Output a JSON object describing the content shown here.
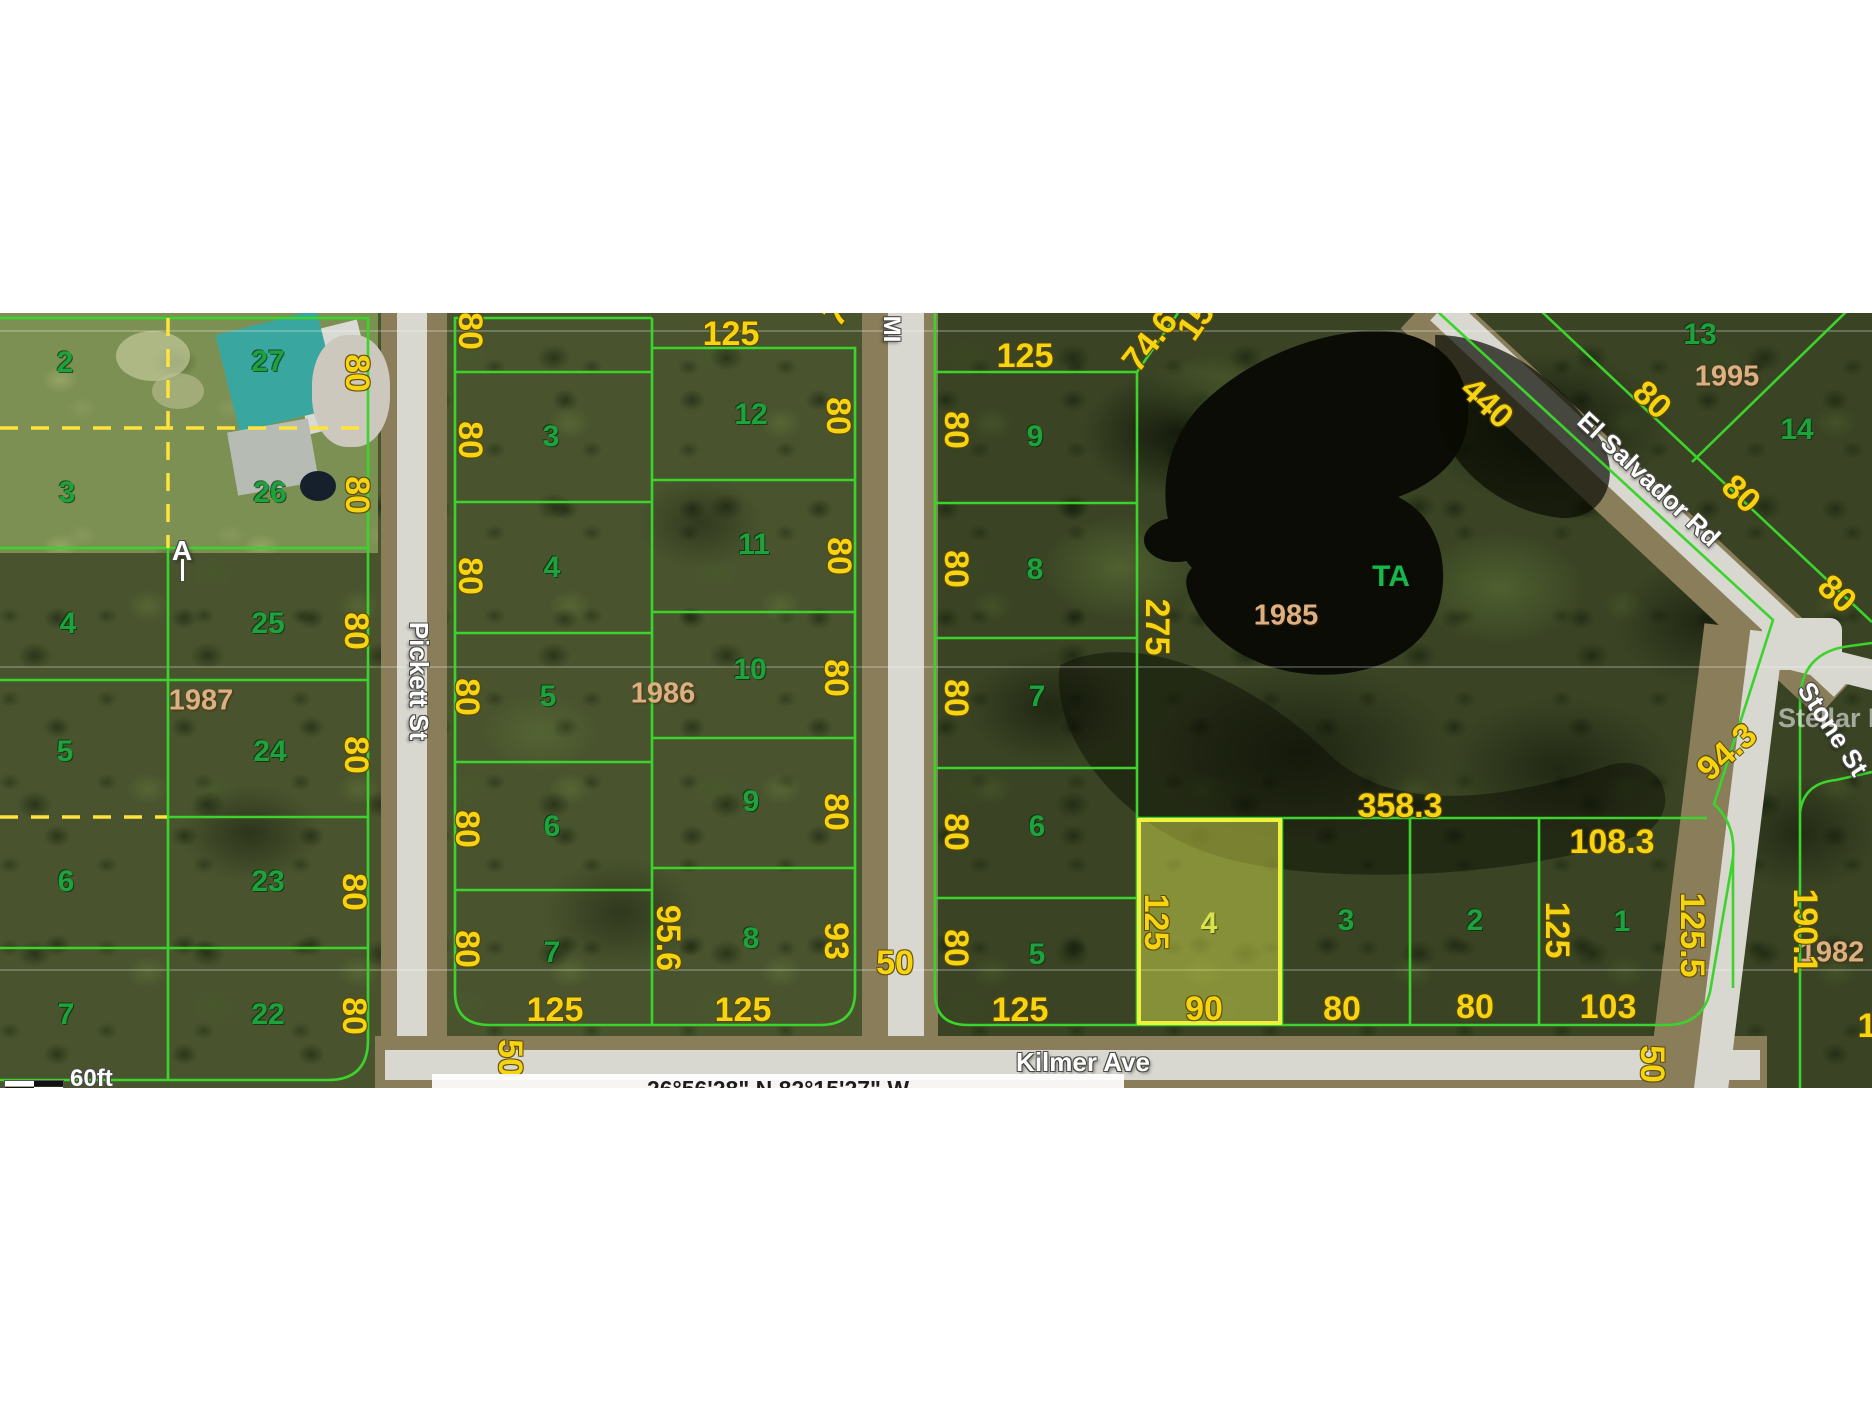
{
  "map": {
    "title": "Aerial plat map with lot dimensions",
    "scale_label": "60ft",
    "coordinates": "26°56'28\" N 82°15'27\" W",
    "watermark": "Stellar MLS",
    "streets": [
      "Pickett St",
      "MI",
      "Kilmer Ave",
      "El Salvador Rd",
      "Stone St"
    ],
    "blocks": [
      "1987",
      "1986",
      "1985",
      "1995",
      "1982"
    ],
    "subject_parcel": {
      "number": "4",
      "block": "1985",
      "frontage": "90",
      "depth": "125"
    },
    "colors": {
      "boundary_green": "#3bd32c",
      "dashed_yellow": "#ffe23c",
      "dimension_yellow": "#f6d411",
      "parcel_green": "#1fa23d",
      "block_tan": "#ddb083",
      "subject_highlight": "#eef23c",
      "water_dark": "#0a0c05"
    },
    "labels": [
      {
        "name": "parcel-2",
        "text": "2",
        "x": 65,
        "y": 363,
        "cls": "num"
      },
      {
        "name": "parcel-27",
        "text": "27",
        "x": 268,
        "y": 362,
        "cls": "num"
      },
      {
        "name": "parcel-3a",
        "text": "3",
        "x": 67,
        "y": 493,
        "cls": "num"
      },
      {
        "name": "parcel-26",
        "text": "26",
        "x": 270,
        "y": 493,
        "cls": "num"
      },
      {
        "name": "parcel-4a",
        "text": "4",
        "x": 68,
        "y": 624,
        "cls": "num"
      },
      {
        "name": "parcel-25",
        "text": "25",
        "x": 268,
        "y": 624,
        "cls": "num"
      },
      {
        "name": "parcel-5a",
        "text": "5",
        "x": 65,
        "y": 752,
        "cls": "num"
      },
      {
        "name": "parcel-24",
        "text": "24",
        "x": 270,
        "y": 752,
        "cls": "num"
      },
      {
        "name": "parcel-6a",
        "text": "6",
        "x": 66,
        "y": 882,
        "cls": "num"
      },
      {
        "name": "parcel-23",
        "text": "23",
        "x": 268,
        "y": 882,
        "cls": "num"
      },
      {
        "name": "parcel-7a",
        "text": "7",
        "x": 66,
        "y": 1015,
        "cls": "num"
      },
      {
        "name": "parcel-22",
        "text": "22",
        "x": 268,
        "y": 1015,
        "cls": "num"
      },
      {
        "name": "dim-80",
        "text": "80",
        "x": 357,
        "y": 373,
        "rot": 90,
        "cls": "dim"
      },
      {
        "name": "dim-80",
        "text": "80",
        "x": 357,
        "y": 495,
        "rot": 90,
        "cls": "dim"
      },
      {
        "name": "dim-80",
        "text": "80",
        "x": 356,
        "y": 631,
        "rot": 90,
        "cls": "dim"
      },
      {
        "name": "dim-80",
        "text": "80",
        "x": 356,
        "y": 755,
        "rot": 90,
        "cls": "dim"
      },
      {
        "name": "dim-80",
        "text": "80",
        "x": 354,
        "y": 892,
        "rot": 90,
        "cls": "dim"
      },
      {
        "name": "dim-80",
        "text": "80",
        "x": 354,
        "y": 1016,
        "rot": 90,
        "cls": "dim"
      },
      {
        "name": "block-1987",
        "text": "1987",
        "x": 201,
        "y": 701,
        "cls": "blk"
      },
      {
        "name": "marker-a",
        "text": "A",
        "x": 182,
        "y": 551,
        "cls": "st",
        "fs": 28
      },
      {
        "name": "parcel-3b",
        "text": "3",
        "x": 551,
        "y": 437,
        "cls": "num"
      },
      {
        "name": "parcel-4b",
        "text": "4",
        "x": 552,
        "y": 568,
        "cls": "num"
      },
      {
        "name": "parcel-5b",
        "text": "5",
        "x": 548,
        "y": 697,
        "cls": "num"
      },
      {
        "name": "parcel-6b",
        "text": "6",
        "x": 552,
        "y": 827,
        "cls": "num"
      },
      {
        "name": "parcel-7b",
        "text": "7",
        "x": 552,
        "y": 953,
        "cls": "num"
      },
      {
        "name": "parcel-12",
        "text": "12",
        "x": 751,
        "y": 415,
        "cls": "num"
      },
      {
        "name": "parcel-11",
        "text": "11",
        "x": 754,
        "y": 545,
        "cls": "num"
      },
      {
        "name": "parcel-10",
        "text": "10",
        "x": 750,
        "y": 670,
        "cls": "num"
      },
      {
        "name": "parcel-9b",
        "text": "9",
        "x": 751,
        "y": 802,
        "cls": "num"
      },
      {
        "name": "parcel-8b",
        "text": "8",
        "x": 751,
        "y": 939,
        "cls": "num"
      },
      {
        "name": "block-1986",
        "text": "1986",
        "x": 663,
        "y": 694,
        "cls": "blk"
      },
      {
        "name": "dim-80",
        "text": "80",
        "x": 470,
        "y": 331,
        "rot": 90,
        "cls": "dim"
      },
      {
        "name": "dim-80",
        "text": "80",
        "x": 470,
        "y": 440,
        "rot": 90,
        "cls": "dim"
      },
      {
        "name": "dim-80",
        "text": "80",
        "x": 470,
        "y": 576,
        "rot": 90,
        "cls": "dim"
      },
      {
        "name": "dim-80",
        "text": "80",
        "x": 467,
        "y": 697,
        "rot": 90,
        "cls": "dim"
      },
      {
        "name": "dim-80",
        "text": "80",
        "x": 467,
        "y": 829,
        "rot": 90,
        "cls": "dim"
      },
      {
        "name": "dim-80",
        "text": "80",
        "x": 467,
        "y": 949,
        "rot": 90,
        "cls": "dim"
      },
      {
        "name": "dim-80",
        "text": "80",
        "x": 838,
        "y": 416,
        "rot": 90,
        "cls": "dim"
      },
      {
        "name": "dim-80",
        "text": "80",
        "x": 839,
        "y": 556,
        "rot": 90,
        "cls": "dim"
      },
      {
        "name": "dim-80",
        "text": "80",
        "x": 836,
        "y": 678,
        "rot": 90,
        "cls": "dim"
      },
      {
        "name": "dim-80",
        "text": "80",
        "x": 836,
        "y": 812,
        "rot": 90,
        "cls": "dim"
      },
      {
        "name": "dim-93",
        "text": "93",
        "x": 836,
        "y": 941,
        "rot": 90,
        "cls": "dim"
      },
      {
        "name": "dim-95-6",
        "text": "95.6",
        "x": 668,
        "y": 938,
        "rot": 90,
        "cls": "dim"
      },
      {
        "name": "dim-125",
        "text": "125",
        "x": 731,
        "y": 334,
        "cls": "dim"
      },
      {
        "name": "dim-125",
        "text": "125",
        "x": 555,
        "y": 1010,
        "cls": "dim"
      },
      {
        "name": "dim-125",
        "text": "125",
        "x": 743,
        "y": 1010,
        "cls": "dim"
      },
      {
        "name": "dim-partial",
        "text": "7",
        "x": 836,
        "y": 314,
        "rot": -50,
        "cls": "dim"
      },
      {
        "name": "dim-50",
        "text": "50",
        "x": 895,
        "y": 963,
        "cls": "dim"
      },
      {
        "name": "dim-50",
        "text": "50",
        "x": 510,
        "y": 1058,
        "rot": 90,
        "cls": "dim"
      },
      {
        "name": "dim-50",
        "text": "50",
        "x": 1652,
        "y": 1064,
        "rot": 90,
        "cls": "dim"
      },
      {
        "name": "parcel-9c",
        "text": "9",
        "x": 1035,
        "y": 437,
        "cls": "num"
      },
      {
        "name": "parcel-8c",
        "text": "8",
        "x": 1035,
        "y": 570,
        "cls": "num"
      },
      {
        "name": "parcel-7c",
        "text": "7",
        "x": 1037,
        "y": 697,
        "cls": "num"
      },
      {
        "name": "parcel-6c",
        "text": "6",
        "x": 1037,
        "y": 827,
        "cls": "num"
      },
      {
        "name": "parcel-5c",
        "text": "5",
        "x": 1037,
        "y": 955,
        "cls": "num"
      },
      {
        "name": "dim-80",
        "text": "80",
        "x": 956,
        "y": 430,
        "rot": 90,
        "cls": "dim"
      },
      {
        "name": "dim-80",
        "text": "80",
        "x": 956,
        "y": 569,
        "rot": 90,
        "cls": "dim"
      },
      {
        "name": "dim-80",
        "text": "80",
        "x": 956,
        "y": 698,
        "rot": 90,
        "cls": "dim"
      },
      {
        "name": "dim-80",
        "text": "80",
        "x": 956,
        "y": 832,
        "rot": 90,
        "cls": "dim"
      },
      {
        "name": "dim-80",
        "text": "80",
        "x": 956,
        "y": 948,
        "rot": 90,
        "cls": "dim"
      },
      {
        "name": "dim-125",
        "text": "125",
        "x": 1025,
        "y": 356,
        "cls": "dim"
      },
      {
        "name": "dim-74-6",
        "text": "74.6",
        "x": 1150,
        "y": 341,
        "rot": -52,
        "cls": "dim"
      },
      {
        "name": "dim-partial-15",
        "text": "15",
        "x": 1196,
        "y": 321,
        "rot": -55,
        "cls": "dim"
      },
      {
        "name": "dim-275",
        "text": "275",
        "x": 1157,
        "y": 627,
        "rot": 90,
        "cls": "dim"
      },
      {
        "name": "label-ta",
        "text": "TA",
        "x": 1391,
        "y": 577,
        "cls": "ta"
      },
      {
        "name": "block-1985",
        "text": "1985",
        "x": 1286,
        "y": 616,
        "cls": "blk"
      },
      {
        "name": "dim-358-3",
        "text": "358.3",
        "x": 1400,
        "y": 806,
        "cls": "dim"
      },
      {
        "name": "dim-108-3",
        "text": "108.3",
        "x": 1612,
        "y": 842,
        "cls": "dim"
      },
      {
        "name": "parcel-4-subject",
        "text": "4",
        "x": 1209,
        "y": 924,
        "cls": "numy"
      },
      {
        "name": "parcel-3c",
        "text": "3",
        "x": 1346,
        "y": 921,
        "cls": "num"
      },
      {
        "name": "parcel-2c",
        "text": "2",
        "x": 1475,
        "y": 921,
        "cls": "num"
      },
      {
        "name": "parcel-1",
        "text": "1",
        "x": 1622,
        "y": 922,
        "cls": "num"
      },
      {
        "name": "dim-125",
        "text": "125",
        "x": 1156,
        "y": 922,
        "rot": 90,
        "cls": "dim"
      },
      {
        "name": "dim-90",
        "text": "90",
        "x": 1204,
        "y": 1009,
        "cls": "dim"
      },
      {
        "name": "dim-80",
        "text": "80",
        "x": 1342,
        "y": 1009,
        "cls": "dim"
      },
      {
        "name": "dim-80",
        "text": "80",
        "x": 1475,
        "y": 1007,
        "cls": "dim"
      },
      {
        "name": "dim-103",
        "text": "103",
        "x": 1608,
        "y": 1007,
        "cls": "dim"
      },
      {
        "name": "dim-125",
        "text": "125",
        "x": 1020,
        "y": 1010,
        "cls": "dim"
      },
      {
        "name": "dim-125",
        "text": "125",
        "x": 1557,
        "y": 930,
        "rot": 90,
        "cls": "dim"
      },
      {
        "name": "dim-125-5",
        "text": "125.5",
        "x": 1692,
        "y": 935,
        "rot": 90,
        "cls": "dim"
      },
      {
        "name": "dim-94-3",
        "text": "94.3",
        "x": 1727,
        "y": 752,
        "rot": -42,
        "cls": "dim"
      },
      {
        "name": "parcel-13",
        "text": "13",
        "x": 1700,
        "y": 335,
        "cls": "num"
      },
      {
        "name": "parcel-14",
        "text": "14",
        "x": 1797,
        "y": 430,
        "cls": "num"
      },
      {
        "name": "block-1995",
        "text": "1995",
        "x": 1727,
        "y": 377,
        "cls": "blk"
      },
      {
        "name": "dim-440",
        "text": "440",
        "x": 1487,
        "y": 403,
        "rot": 43,
        "cls": "dim"
      },
      {
        "name": "dim-80",
        "text": "80",
        "x": 1652,
        "y": 400,
        "rot": 43,
        "cls": "dim"
      },
      {
        "name": "dim-80",
        "text": "80",
        "x": 1741,
        "y": 494,
        "rot": 43,
        "cls": "dim"
      },
      {
        "name": "dim-80",
        "text": "80",
        "x": 1837,
        "y": 594,
        "rot": 43,
        "cls": "dim"
      },
      {
        "name": "block-1982",
        "text": "1982",
        "x": 1832,
        "y": 953,
        "cls": "blk"
      },
      {
        "name": "dim-190-1",
        "text": "190.1",
        "x": 1805,
        "y": 931,
        "rot": 90,
        "cls": "dim"
      },
      {
        "name": "dim-partial-125",
        "text": "125",
        "x": 1886,
        "y": 1026,
        "cls": "dim"
      },
      {
        "name": "street-pickett",
        "text": "Pickett St",
        "x": 419,
        "y": 681,
        "rot": 90,
        "cls": "st"
      },
      {
        "name": "street-mi",
        "text": "MI",
        "x": 891,
        "y": 329,
        "rot": 90,
        "cls": "st",
        "fs": 24
      },
      {
        "name": "street-kilmer",
        "text": "Kilmer Ave",
        "x": 1083,
        "y": 1062,
        "cls": "st"
      },
      {
        "name": "street-el-salvador",
        "text": "El Salvador Rd",
        "x": 1649,
        "y": 479,
        "rot": 43,
        "cls": "st"
      },
      {
        "name": "street-stone",
        "text": "Stone St",
        "x": 1833,
        "y": 729,
        "rot": 57,
        "cls": "st"
      }
    ]
  }
}
